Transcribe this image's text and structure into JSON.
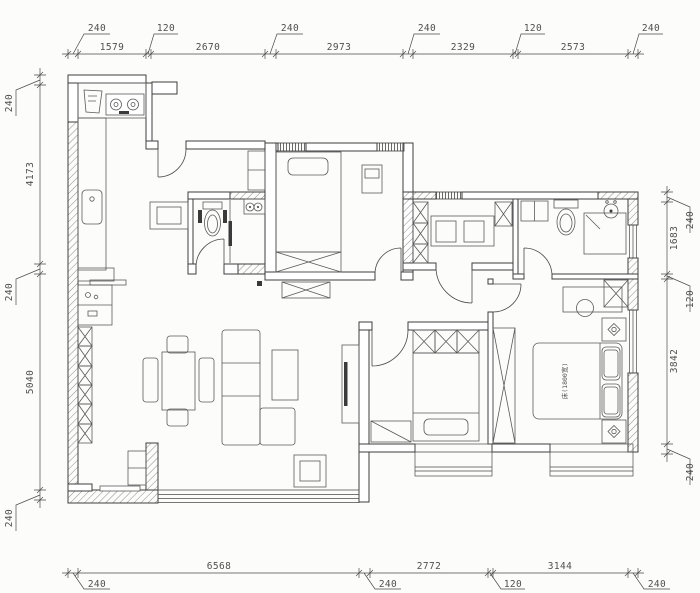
{
  "dims": {
    "top": [
      "240",
      "1579",
      "120",
      "2670",
      "240",
      "2973",
      "240",
      "2329",
      "120",
      "2573",
      "240"
    ],
    "bottom": [
      "240",
      "6568",
      "240",
      "2772",
      "120",
      "3144",
      "240"
    ],
    "left": [
      "240",
      "4173",
      "240",
      "5040",
      "240"
    ],
    "right": [
      "240",
      "1683",
      "120",
      "3842",
      "240"
    ]
  },
  "labels": {
    "master_bed": "床(1800宽)"
  },
  "colors": {
    "wall_line": "#3e3e3e",
    "furniture_line": "#5a5a5a",
    "dim_text": "#4f4f4f",
    "background": "#fcfcfb"
  }
}
